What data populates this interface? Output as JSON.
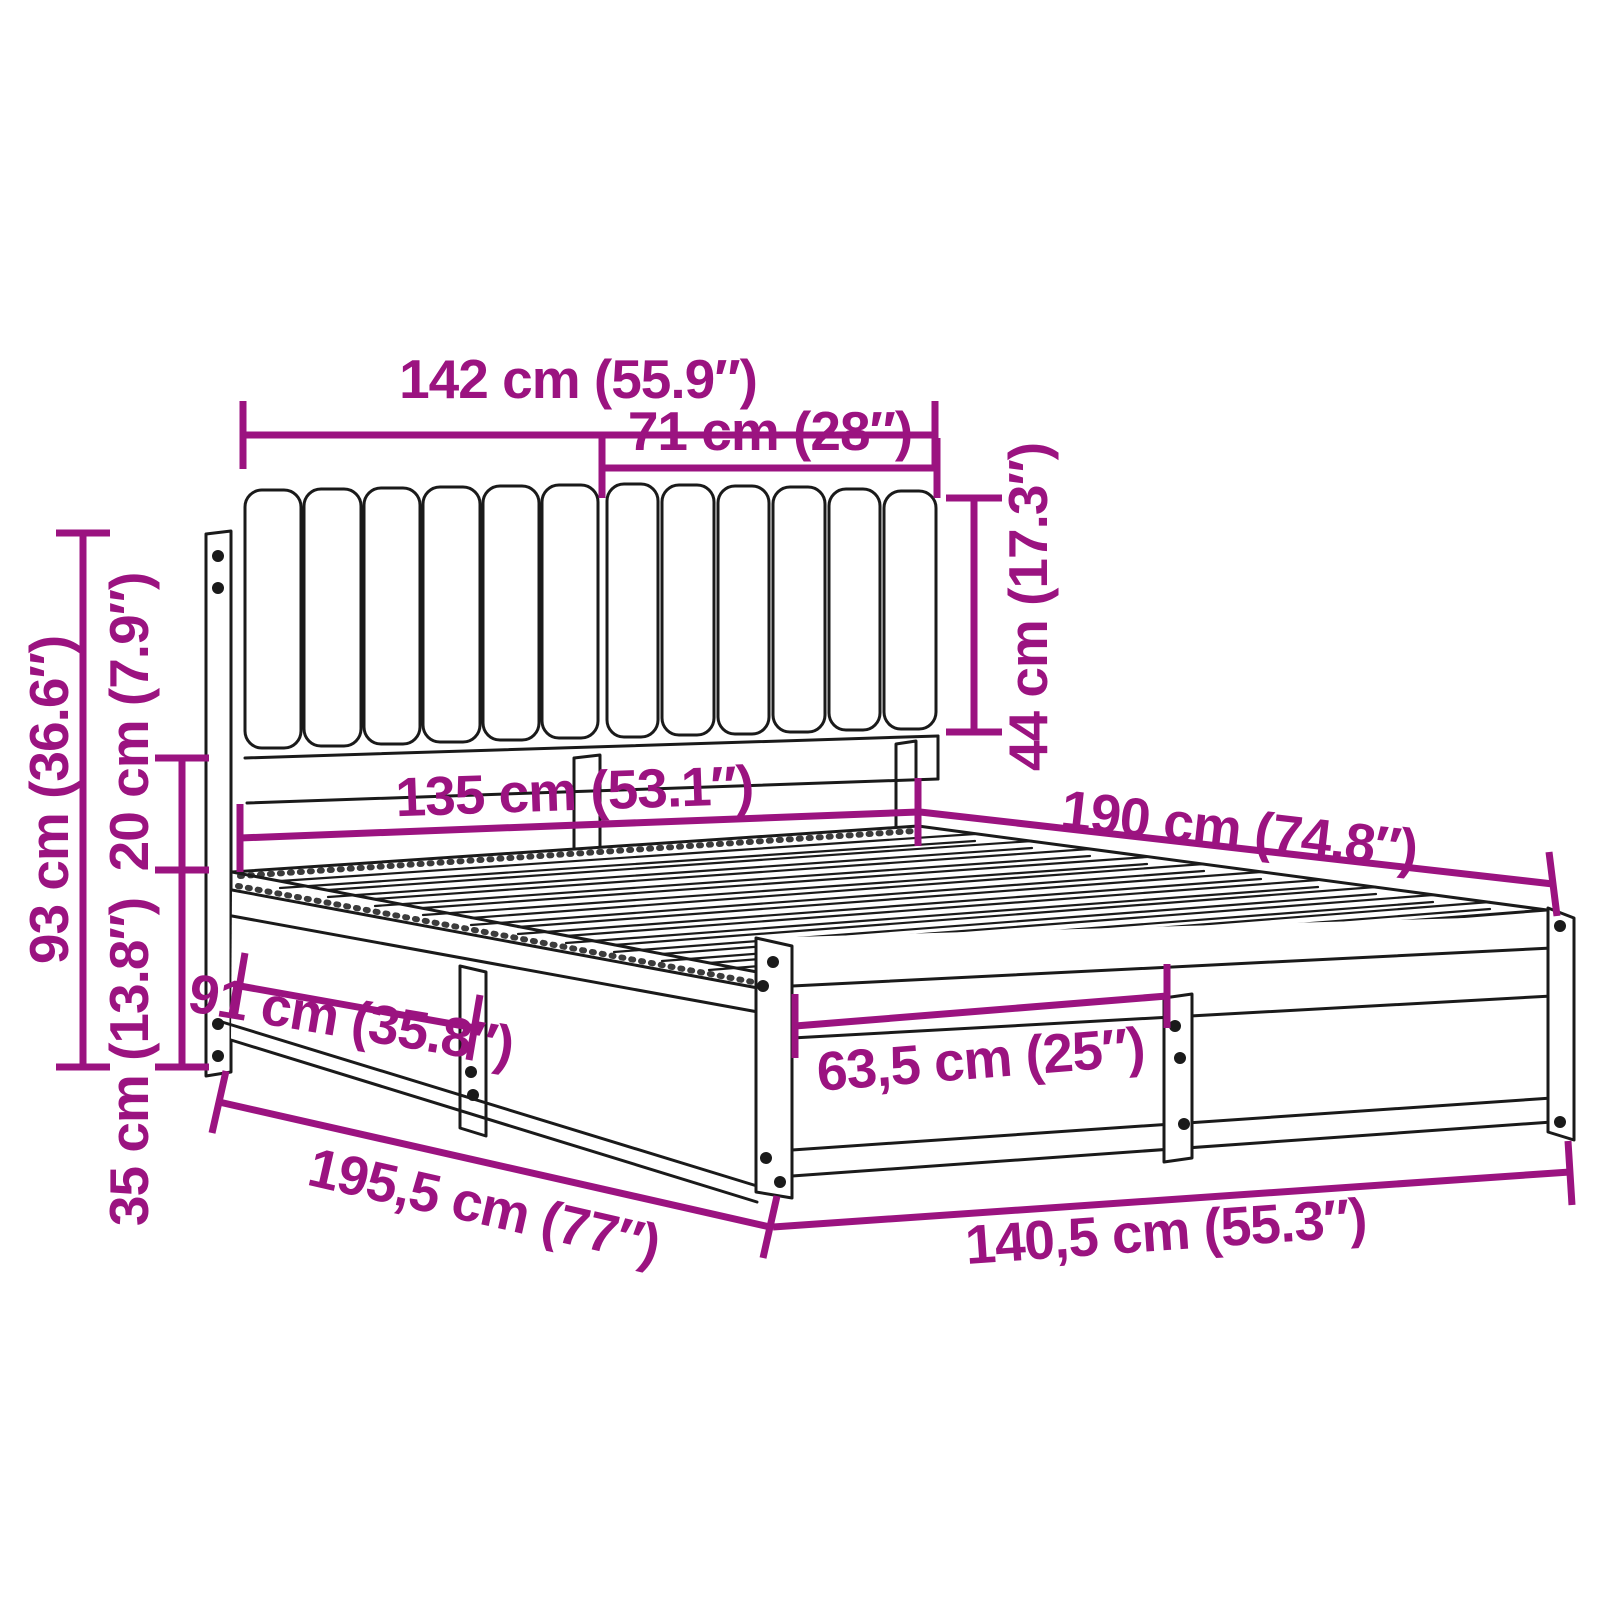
{
  "diagram": {
    "title": "bed-frame-dimension-diagram",
    "product": "bed frame with channel-tufted headboard cushions and slatted base",
    "accent_color": "#9B1380",
    "line_color": "#1A1A1A",
    "background_color": "#FFFFFF",
    "units": [
      "cm",
      "inches"
    ],
    "dimensions": [
      {
        "id": "headboard-total-width",
        "label": "142 cm (55.9″)",
        "cm": 142,
        "inches": 55.9
      },
      {
        "id": "cushion-width",
        "label": "71 cm (28″)",
        "cm": 71,
        "inches": 28
      },
      {
        "id": "cushion-height",
        "label": "44 cm (17.3″)",
        "cm": 44,
        "inches": 17.3
      },
      {
        "id": "headboard-height",
        "label": "93 cm (36.6″)",
        "cm": 93,
        "inches": 36.6
      },
      {
        "id": "gap-under-cushion",
        "label": "20 cm (7.9″)",
        "cm": 20,
        "inches": 7.9
      },
      {
        "id": "frame-height",
        "label": "35 cm (13.8″)",
        "cm": 35,
        "inches": 13.8
      },
      {
        "id": "inner-width-head",
        "label": "135 cm (53.1″)",
        "cm": 135,
        "inches": 53.1
      },
      {
        "id": "inner-length",
        "label": "190 cm (74.8″)",
        "cm": 190,
        "inches": 74.8
      },
      {
        "id": "side-section-length",
        "label": "91 cm (35.8″)",
        "cm": 91,
        "inches": 35.8
      },
      {
        "id": "foot-panel-section",
        "label": "63,5 cm (25″)",
        "cm": 63.5,
        "inches": 25
      },
      {
        "id": "total-length",
        "label": "195,5 cm (77″)",
        "cm": 195.5,
        "inches": 77
      },
      {
        "id": "outer-width-foot",
        "label": "140,5 cm (55.3″)",
        "cm": 140.5,
        "inches": 55.3
      }
    ]
  }
}
